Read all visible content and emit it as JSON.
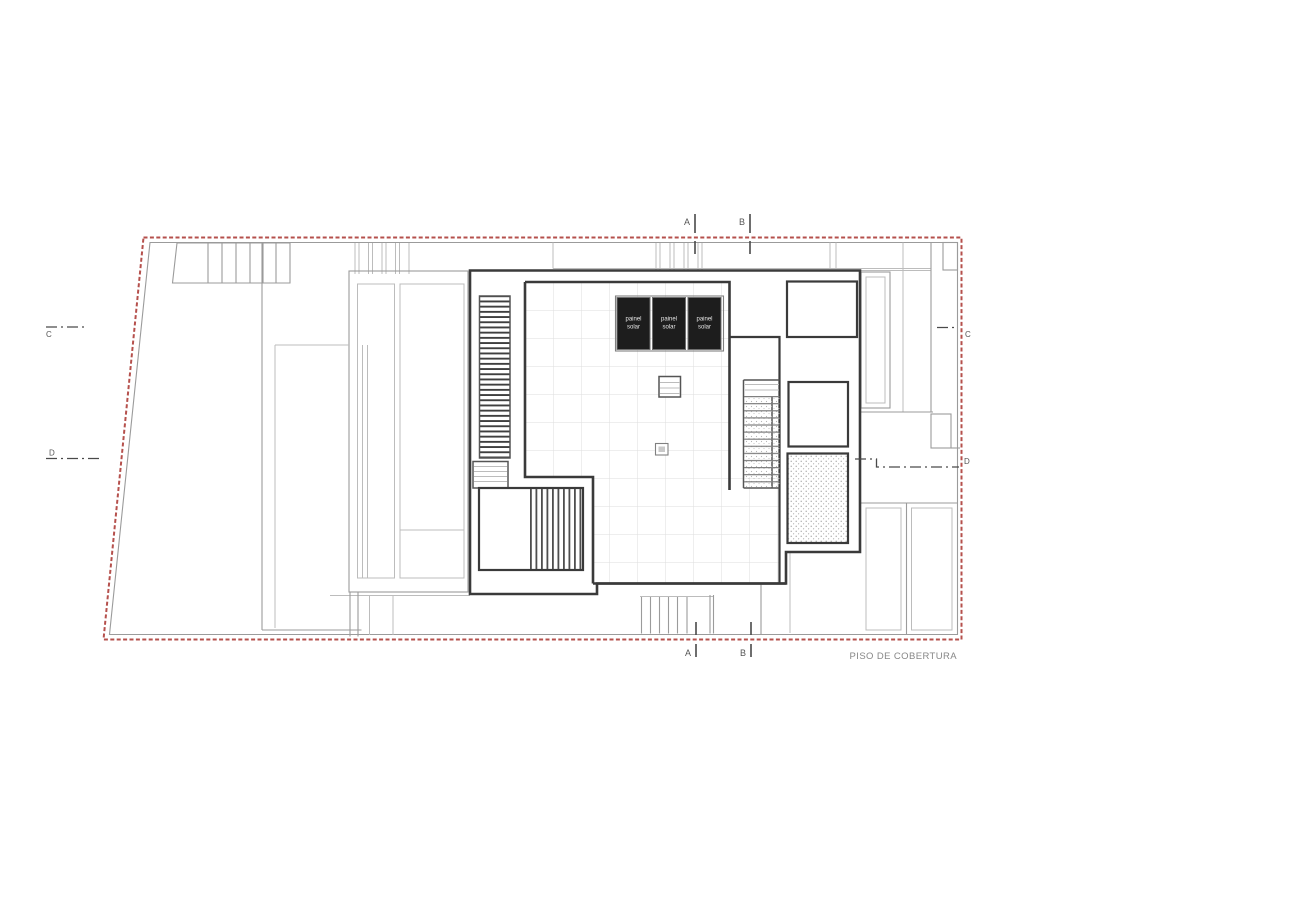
{
  "plan": {
    "title": "PISO DE COBERTURA",
    "markers": {
      "a": "A",
      "b": "B",
      "c": "C",
      "d": "D"
    },
    "solar_panel_label": {
      "line1": "painel",
      "line2": "solar"
    },
    "solar_panel_count": 3,
    "colors": {
      "boundary_red": "#b5504c",
      "wall_dark": "#3a3a3a",
      "line_gray": "#9b9b9b",
      "line_light": "#bcbcbc",
      "panel_fill": "#1d1d1d",
      "panel_text": "#e9e9e9",
      "marker_text": "#555555",
      "title_text": "#878787",
      "grid_line": "#dedede"
    }
  }
}
